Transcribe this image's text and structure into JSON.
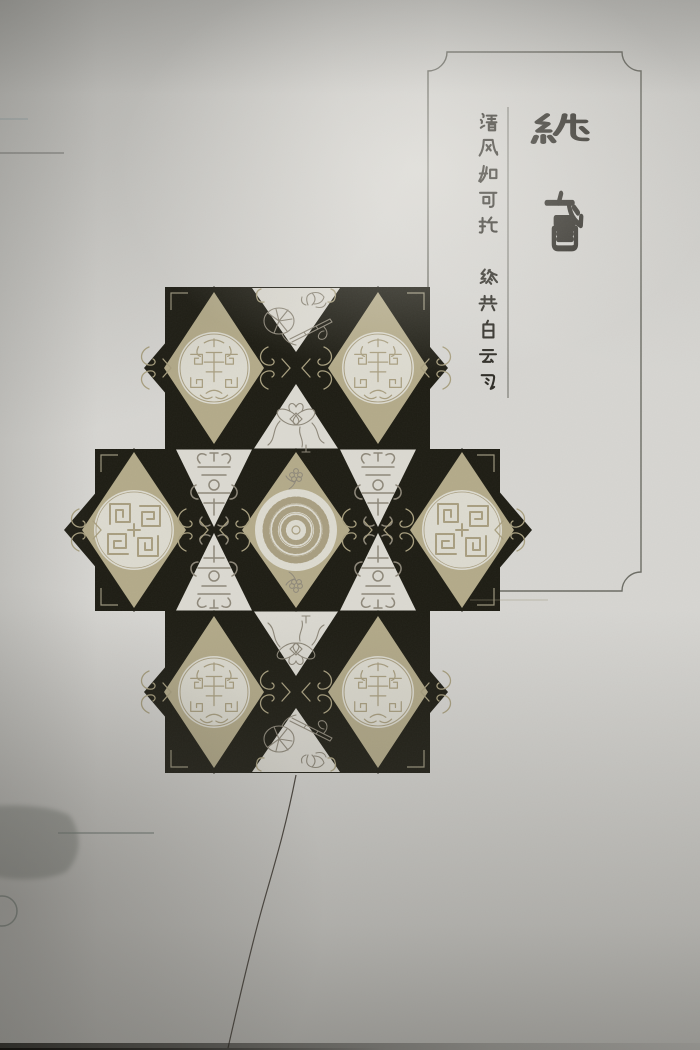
{
  "photo": {
    "kind": "photograph of a printed kite-design page",
    "bottom_shadow": "dark table edge at bottom of photo"
  },
  "title_panel": {
    "title": "紙鳶",
    "poem_line_1": "清风如可托",
    "poem_line_2": "终共白云飞"
  },
  "kite": {
    "layout": "plus-shaped checkerboard kite face",
    "medallion_corner": "round longevity (tuan-shou) roundel x4",
    "medallion_side": "four-quadrant meander roundel x2",
    "medallion_center": "hundred-character ring roundel x1",
    "ornament_lotus": "lotus and flute line drawing",
    "ornament_knot": "ribbon knot line drawing",
    "ornament_shou": "ornamental shou emblem x4",
    "ornament_sprig": "flower sprig x2",
    "junction_motif": "bat curls with chevron marks",
    "corner_motif": "thin corner brackets"
  },
  "colors": {
    "paper": "#d6d5d1",
    "kite-black": "#1d1c13",
    "kite-tan": "#b3aa89",
    "kite-white": "#dbd9d1",
    "medallion-fill": "#dcdacf",
    "medallion-line": "#a89e80",
    "ornament-line": "#8d8779",
    "bat-line": "#a89f7f",
    "bracket-line": "#9a947c",
    "ink": "#2e2c26",
    "panel-border": "#6b6b63",
    "string": "#453f38"
  }
}
